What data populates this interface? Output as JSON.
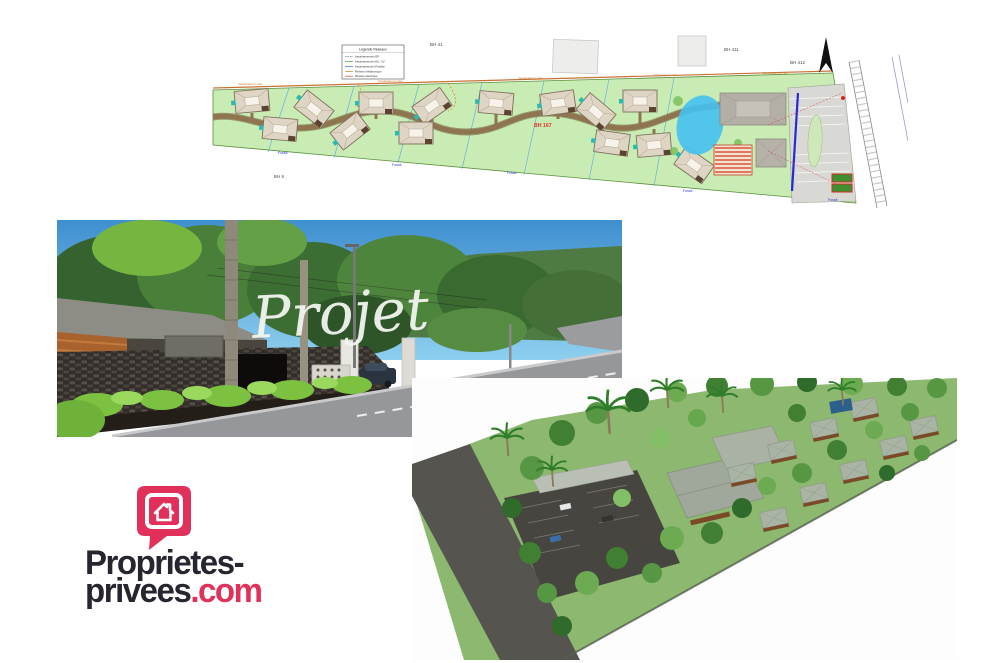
{
  "page": {
    "background": "#ffffff"
  },
  "site_plan": {
    "labels": {
      "bh41": "BH 41",
      "bh411": "BH 411",
      "bh412": "BH 412",
      "bh6": "BH 6",
      "bh167": "BH 167"
    },
    "fosse_label": "Fossé",
    "canalisation_label": "Canalisation à créer",
    "legend": {
      "title": "Légende Réseaux",
      "items": [
        "Assainissement EP",
        "Assainissement EU, CV",
        "Assainissement Potable",
        "Réseau téléphonique",
        "Réseau électrique"
      ]
    },
    "colors": {
      "parcel_green": "#c9ecb4",
      "road_brown": "#8f7450",
      "pond_blue": "#45c2ef",
      "panel_red": "#d95535",
      "canal_blue": "#2828d8"
    }
  },
  "street_view": {
    "overlay_text": "Projet"
  },
  "aerial_view": {},
  "logo": {
    "line1": "Proprietes-",
    "line2": "privees",
    "suffix": ".com",
    "brand_pink": "#e1315a",
    "brand_dark": "#262630"
  }
}
